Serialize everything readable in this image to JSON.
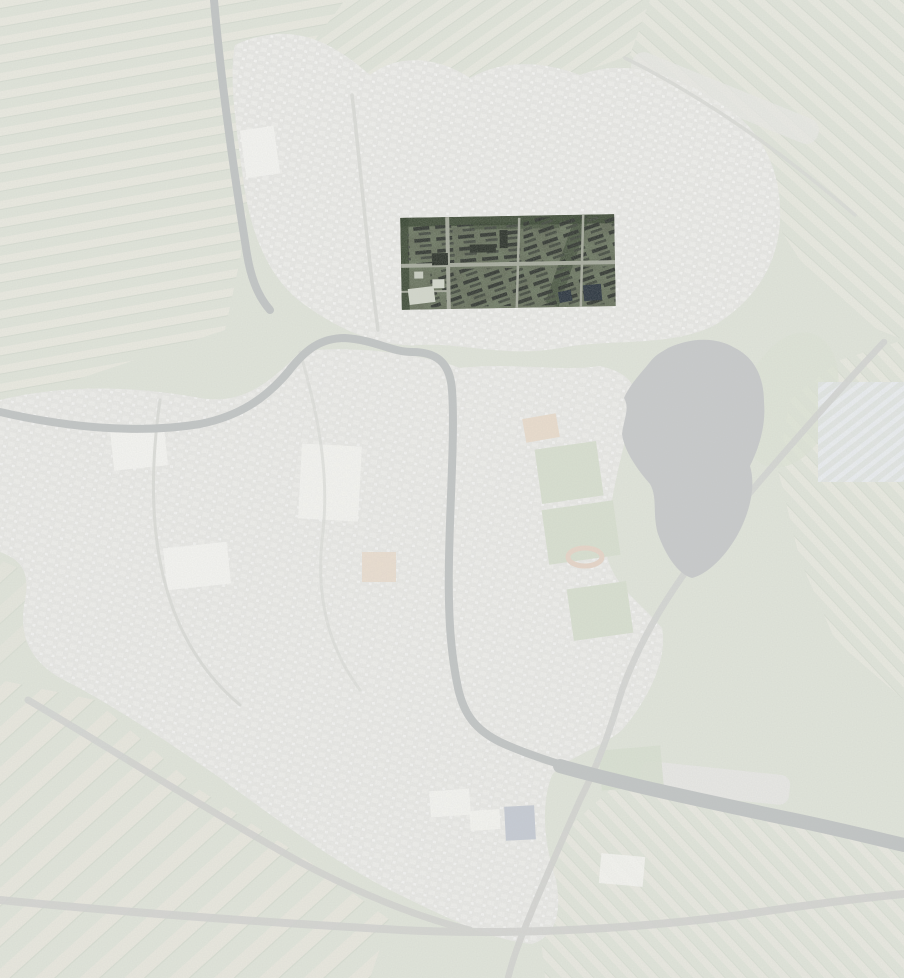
{
  "map": {
    "title": "Faded aerial photograph of a town with one neighborhood highlighted in full color",
    "view_type": "satellite-aerial",
    "canvas": {
      "width": 904,
      "height": 978
    },
    "highlight": {
      "x": 401,
      "y": 216,
      "width": 214,
      "height": 92,
      "rotation": -1
    },
    "features": {
      "highlight_region": "full-color highlighted neighborhood",
      "lake": "gray lake right of center",
      "canal_north": "canal entering from top edge",
      "canal_main": "canal winding through town to south-east",
      "farmland": "strip-parcelled polder fields",
      "urban_area": "washed-out town fabric",
      "sports_fields": "sports field complex",
      "greenhouses": "greenhouse block at right edge",
      "highways": "ring roads and motorway interchange"
    },
    "colors": {
      "base": "#e9eae6",
      "field": "#e0e4da",
      "field_strip": "#ebeae2",
      "field_pale": "#e9e7df",
      "field_line": "#ccd2c6",
      "urban": "#e8e8e5",
      "urban_block": "#f3f3f0",
      "white_bldg": "#f4f4f1",
      "water": "#c2c5c5",
      "lake": "#c8cacb",
      "road": "#d9dad6",
      "highway": "#d3d4d1",
      "sport_green": "#d8dfd0",
      "golf": "#dde3d6",
      "clay_orange": "#e9dccd",
      "track_orange": "#e6d5c8",
      "navy_faded": "#c6cbd4",
      "greenhouse_a": "#eaedf1",
      "greenhouse_b": "#e1e5e3",
      "hl_base": "#575d4c",
      "hl_tree": "#2c3a26",
      "hl_road": "#a4a89b",
      "hl_block": "#262b26",
      "hl_roof": "#20261f",
      "hl_white": "#d3d7cc",
      "hl_navy": "#202a36"
    }
  }
}
